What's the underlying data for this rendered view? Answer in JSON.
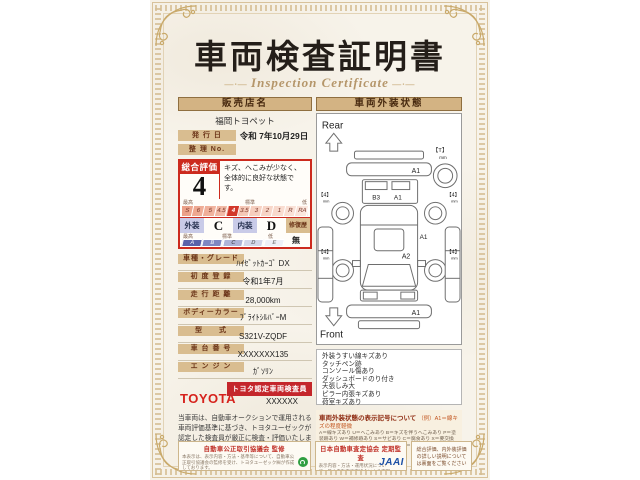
{
  "title": "車両検査証明書",
  "subtitle": "Inspection Certificate",
  "colors": {
    "accent_red": "#cc2a1e",
    "tan": "#d3b383",
    "toyota_red": "#d6221c",
    "jaai_blue": "#1b4fa5",
    "fair_trade_green": "#2f9e41"
  },
  "dealer": {
    "label": "販売店名",
    "name": "福岡トヨペット"
  },
  "issue": {
    "label": "発 行 日",
    "value": "令和 7年10月29日"
  },
  "serial": {
    "label": "整 理 No.",
    "value": ""
  },
  "overall": {
    "label": "総合評価",
    "score": "4",
    "comment": "キズ、へこみが少なく、全体的に良好な状態です。",
    "scale_labels": [
      "最高",
      "標準",
      "低"
    ],
    "scale": [
      "S",
      "6",
      "5",
      "4.5",
      "4",
      "3.5",
      "3",
      "2",
      "1",
      "R",
      "RA"
    ],
    "selected": "4"
  },
  "grades": {
    "exterior_label": "外装",
    "exterior": "C",
    "interior_label": "内装",
    "interior": "D",
    "repair_label": "修復歴",
    "repair": "無",
    "scale_labels": [
      "最高",
      "標準",
      "低"
    ],
    "scale": [
      "A",
      "B",
      "C",
      "D",
      "E"
    ]
  },
  "details": [
    {
      "label": "車種・グレード",
      "value": "ﾊｲｾﾞｯﾄｶｰｺﾞ DX"
    },
    {
      "label": "初 度 登 録",
      "value": "令和1年7月"
    },
    {
      "label": "走 行 距 離",
      "value": "28,000km"
    },
    {
      "label": "ボディーカラー",
      "value": "ﾌﾞﾗｲﾄｼﾙﾊﾞｰM"
    },
    {
      "label": "型　　式",
      "value": "S321V-ZQDF"
    },
    {
      "label": "車 台 番 号",
      "value": "XXXXXXX135"
    },
    {
      "label": "エ ン ジ ン",
      "value": "ｶﾞｿﾘﾝ"
    }
  ],
  "inspector": {
    "brand": "TOYOTA",
    "badge": "トヨタ認定車両検査員",
    "name": "XXXXXX"
  },
  "disclaimer": "当車両は、自動車オークションで運用される車両評価基準に基づき、トヨタユーゼックが認定した検査員が厳正に検査・評価いたしました。",
  "exterior_panel": {
    "header": "車両外装状態",
    "rear_label": "Rear",
    "front_label": "Front",
    "marks": {
      "rear_bumper": "A1",
      "gate_b": "B3",
      "gate_a": "A1",
      "side": "A1",
      "cargo": "A2",
      "front_bumper": "A1",
      "spare": "【T】",
      "tire": "【4】",
      "unit": "mm"
    },
    "notes": [
      "外装うすい線キズあり",
      "タッチペン跡",
      "コンソール傷あり",
      "ダッシュボードのり付き",
      "天張しみ大",
      "ピラー内張キズあり",
      "荷室キズあり"
    ],
    "legend_title": "車両外装状態の表示記号について",
    "legend_example": "（例）A1＝線キズの程度軽微",
    "legend_body": "A＝線キズあり U＝へこみあり B＝キズを伴うへこみあり P＝塗装跡あり W＝補修跡あり S＝サビあり C＝腐食あり X＝要交換 XX＝交換済み ／ 1＝小程度 2＝中程度 3＝中程度以上 ※数字はキズや損傷の程度を表しています。"
  },
  "footer": {
    "left": {
      "title": "自動車公正取引協議会 監修",
      "body": "本表示は、表示内容・方法・基準等について、自動車公正取引協議会の監修を受け、トヨタユーゼック㈱が作成しております。"
    },
    "center": {
      "title": "日本自動車査定協会 定期監査",
      "body": "表示内容・方法・運用状況について、日本自動車査定協会による定期監査を受けています。",
      "logo": "JAAI"
    },
    "right": {
      "body": "総合評価、内外装評価の詳しい説明については裏面をご覧ください"
    }
  }
}
